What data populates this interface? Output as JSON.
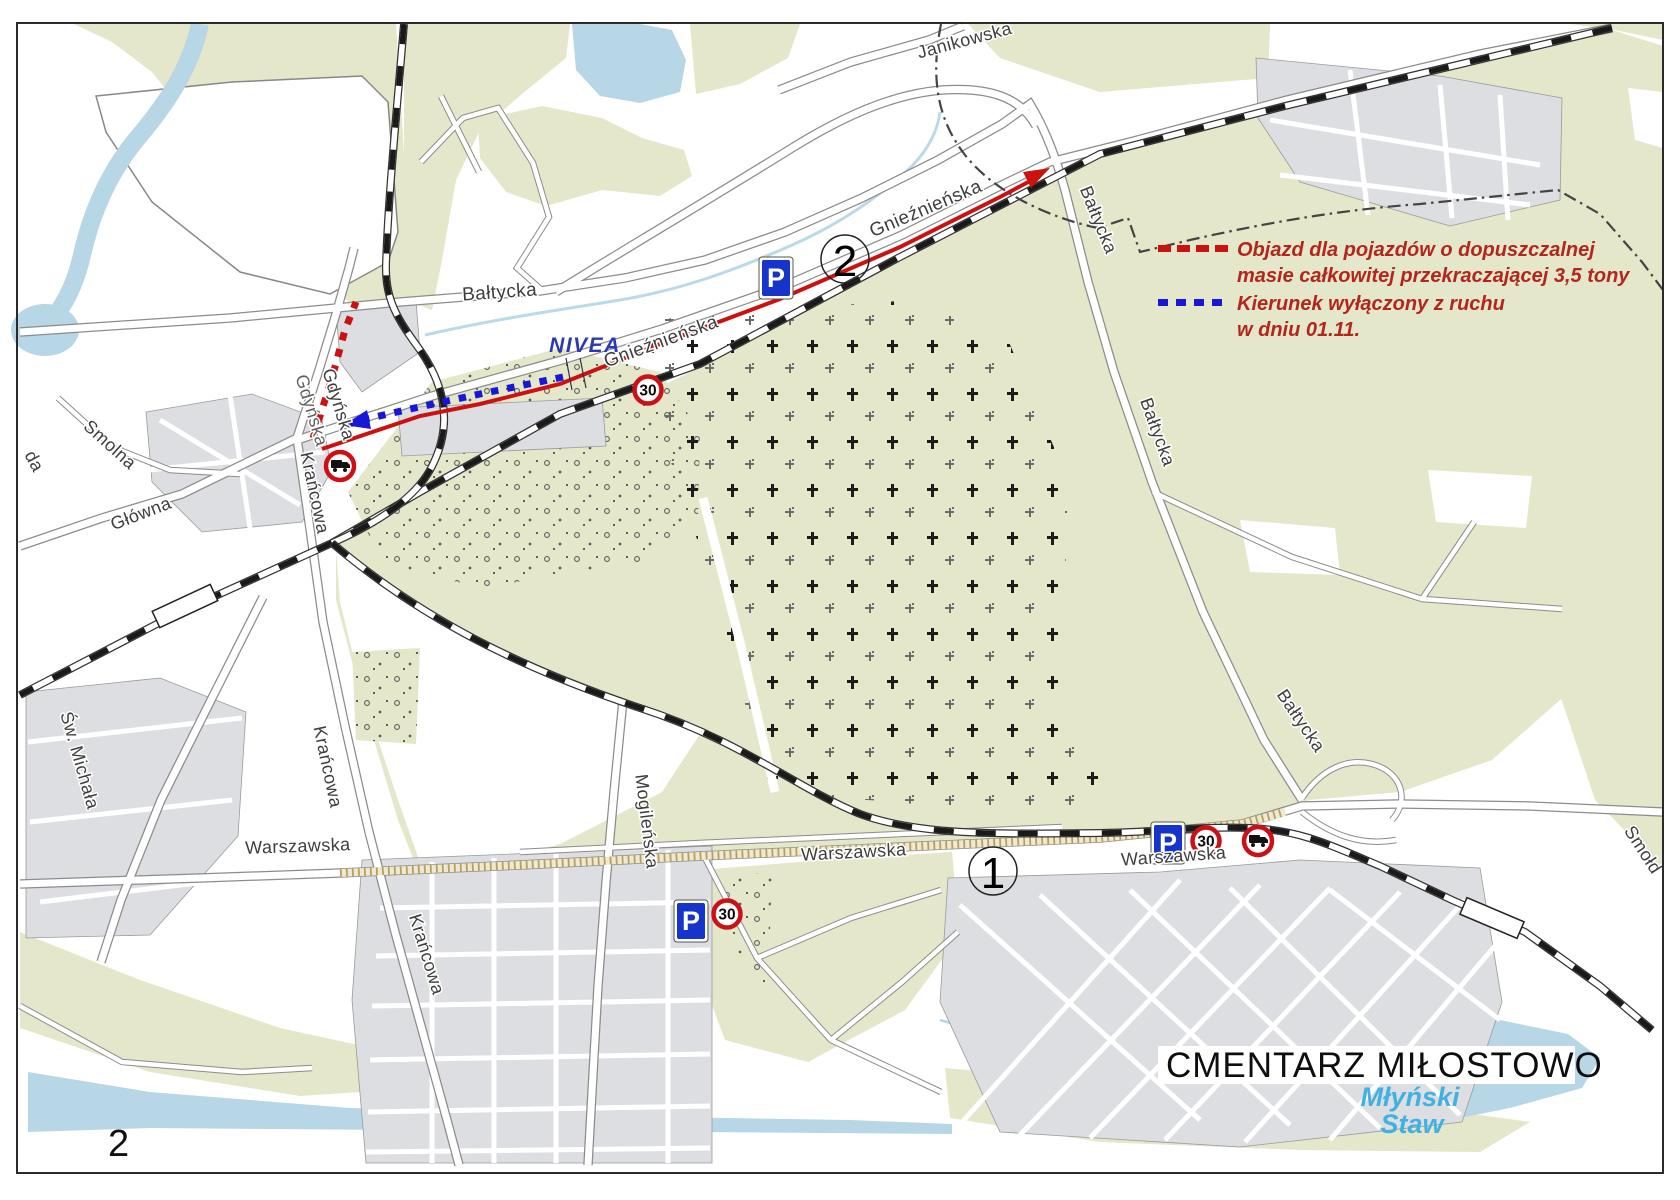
{
  "page": {
    "number": "2"
  },
  "legend": {
    "detour_line1": "Objazd dla pojazdów o dopuszczalnej",
    "detour_line2": "masie całkowitej przekraczającej 3,5 tony",
    "closed_line1": "Kierunek wyłączony z ruchu",
    "closed_line2": "w dniu 01.11.",
    "detour_color": "#cc1111",
    "closed_color": "#1717d8",
    "text_color": "#b3261e"
  },
  "map": {
    "title": "CMENTARZ MIŁOSTOWO",
    "pond_name_line1": "Młyński",
    "pond_name_line2": "Staw",
    "factory": "NIVEA",
    "route_points": {
      "p1": "1",
      "p2": "2"
    },
    "signs": {
      "parking": "P",
      "speed_limit": "30",
      "parking_bg": "#1633cc",
      "ring_color": "#cc1016"
    },
    "streets": {
      "baltycka": "Bałtycka",
      "gniezninska": "Gnieźnieńska",
      "janikowska": "Janikowska",
      "gdynska": "Gdyńska",
      "smolna": "Smolna",
      "glowna": "Główna",
      "krancowa": "Krańcowa",
      "sw_michala": "Św. Michała",
      "mogilenska": "Mogileńska",
      "warszawska": "Warszawska",
      "smold": "Smołd",
      "da": "da"
    },
    "colors": {
      "green": "#e4e7c9",
      "water": "#b7d6e6",
      "urban": "#dcdee1",
      "road_casing": "#8c8c8c",
      "pond_label": "#41b1e1",
      "nivea_label": "#2a3ab5"
    }
  }
}
